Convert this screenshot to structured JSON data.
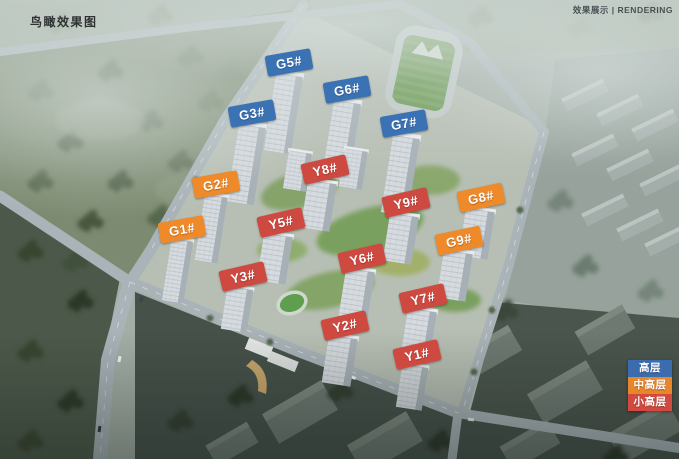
{
  "page": {
    "title": "鸟瞰效果图",
    "corner_note": "效果展示 | RENDERING"
  },
  "buildings": [
    {
      "label": "G5#",
      "category": "高层"
    },
    {
      "label": "G6#",
      "category": "高层"
    },
    {
      "label": "G7#",
      "category": "高层"
    },
    {
      "label": "G3#",
      "category": "高层"
    },
    {
      "label": "G2#",
      "category": "中高层"
    },
    {
      "label": "G1#",
      "category": "中高层"
    },
    {
      "label": "Y8#",
      "category": "小高层"
    },
    {
      "label": "Y9#",
      "category": "小高层"
    },
    {
      "label": "G8#",
      "category": "中高层"
    },
    {
      "label": "Y5#",
      "category": "小高层"
    },
    {
      "label": "G9#",
      "category": "中高层"
    },
    {
      "label": "Y6#",
      "category": "小高层"
    },
    {
      "label": "Y3#",
      "category": "小高层"
    },
    {
      "label": "Y7#",
      "category": "小高层"
    },
    {
      "label": "Y2#",
      "category": "小高层"
    },
    {
      "label": "Y1#",
      "category": "小高层"
    }
  ],
  "legend": {
    "items": [
      {
        "label": "高层",
        "color": "#3b6cae"
      },
      {
        "label": "中高层",
        "color": "#e8862b"
      },
      {
        "label": "小高层",
        "color": "#d2493f"
      }
    ]
  },
  "colors": {
    "label_high": "#3b72b4",
    "label_midhigh": "#ee8a2a",
    "label_smallhigh": "#ce4a41"
  }
}
